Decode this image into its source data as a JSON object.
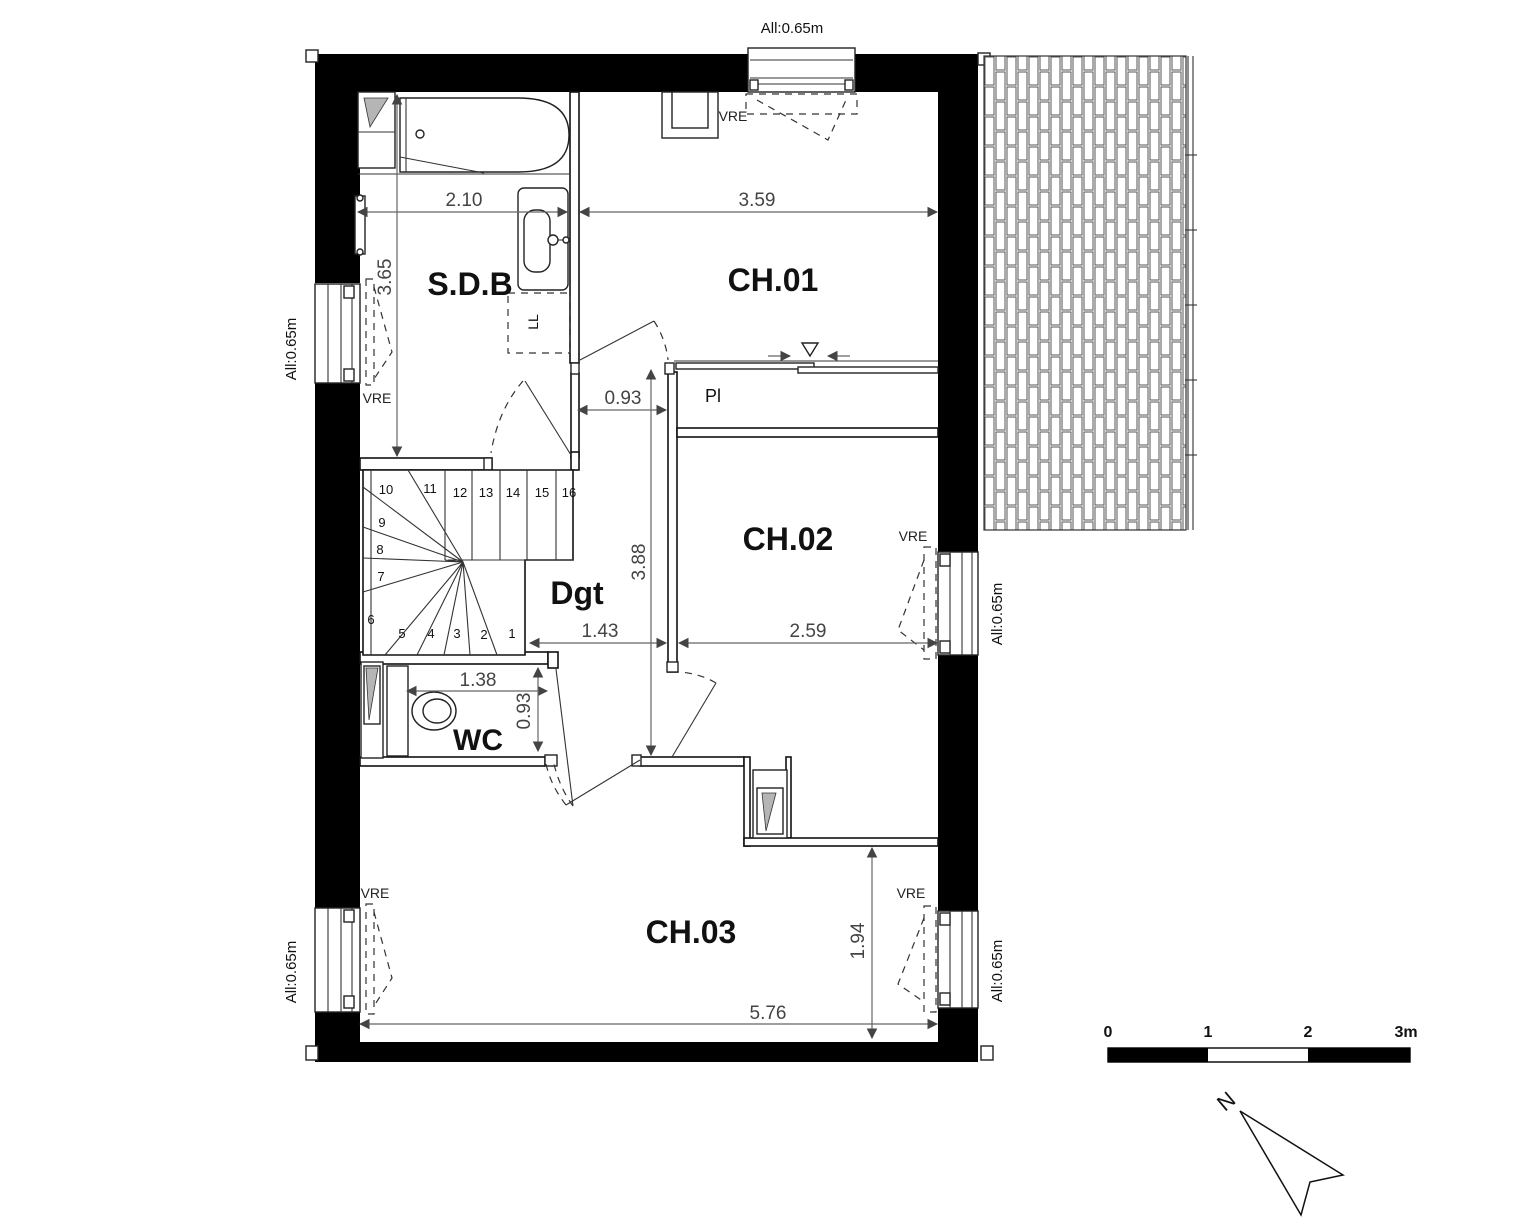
{
  "drawing": {
    "type": "architectural-floor-plan",
    "scale_bar": {
      "labels": [
        "0",
        "1",
        "2",
        "3m"
      ]
    },
    "north_label": "N",
    "rooms": [
      "S.D.B",
      "CH.01",
      "CH.02",
      "CH.03",
      "Dgt",
      "WC"
    ],
    "annotations": [
      "Pl",
      "LL",
      "VRE",
      "All:0.65m"
    ],
    "dimensions_m": [
      "2.10",
      "3.59",
      "3.65",
      "0.93",
      "3.88",
      "1.43",
      "2.59",
      "1.38",
      "0.93",
      "1.94",
      "5.76"
    ],
    "stair_steps": 16
  },
  "colors": {
    "wall": "#000000",
    "line": "#111111",
    "dimension": "#444444",
    "hatch_gray": "#b5b5b5",
    "background": "#ffffff"
  },
  "texts": [
    {
      "id": "room-label-sdb",
      "t": "S.D.B",
      "x": 470,
      "y": 295,
      "s": 32,
      "w": "bold"
    },
    {
      "id": "room-label-ch01",
      "t": "CH.01",
      "x": 773,
      "y": 291,
      "s": 32,
      "w": "bold"
    },
    {
      "id": "room-label-ch02",
      "t": "CH.02",
      "x": 788,
      "y": 550,
      "s": 32,
      "w": "bold"
    },
    {
      "id": "room-label-ch03",
      "t": "CH.03",
      "x": 691,
      "y": 943,
      "s": 32,
      "w": "bold"
    },
    {
      "id": "room-label-dgt",
      "t": "Dgt",
      "x": 577,
      "y": 604,
      "s": 32,
      "w": "bold"
    },
    {
      "id": "room-label-wc",
      "t": "WC",
      "x": 478,
      "y": 750,
      "s": 30,
      "w": "bold"
    },
    {
      "id": "closet-label-pl",
      "t": "Pl",
      "x": 713,
      "y": 402,
      "s": 18
    },
    {
      "id": "appliance-label-ll",
      "t": "LL",
      "x": 538,
      "y": 322,
      "s": 14,
      "r": -90
    },
    {
      "id": "dim-2-10",
      "t": "2.10",
      "x": 464,
      "y": 206,
      "s": 19,
      "c": "#444"
    },
    {
      "id": "dim-3-59",
      "t": "3.59",
      "x": 757,
      "y": 206,
      "s": 19,
      "c": "#444"
    },
    {
      "id": "dim-0-93-top",
      "t": "0.93",
      "x": 623,
      "y": 404,
      "s": 19,
      "c": "#444"
    },
    {
      "id": "dim-1-43",
      "t": "1.43",
      "x": 600,
      "y": 637,
      "s": 19,
      "c": "#444"
    },
    {
      "id": "dim-2-59",
      "t": "2.59",
      "x": 808,
      "y": 637,
      "s": 19,
      "c": "#444"
    },
    {
      "id": "dim-1-38",
      "t": "1.38",
      "x": 478,
      "y": 686,
      "s": 19,
      "c": "#444"
    },
    {
      "id": "dim-5-76",
      "t": "5.76",
      "x": 768,
      "y": 1019,
      "s": 19,
      "c": "#444"
    },
    {
      "id": "dim-3-65",
      "t": "3.65",
      "x": 391,
      "y": 277,
      "s": 19,
      "c": "#444",
      "r": -90
    },
    {
      "id": "dim-3-88",
      "t": "3.88",
      "x": 645,
      "y": 562,
      "s": 19,
      "c": "#444",
      "r": -90
    },
    {
      "id": "dim-0-93-wc",
      "t": "0.93",
      "x": 530,
      "y": 711,
      "s": 19,
      "c": "#444",
      "r": -90
    },
    {
      "id": "dim-1-94",
      "t": "1.94",
      "x": 864,
      "y": 941,
      "s": 19,
      "c": "#444",
      "r": -90
    },
    {
      "id": "sill-label-top",
      "t": "All:0.65m",
      "x": 792,
      "y": 33,
      "s": 15
    },
    {
      "id": "sill-label-left-upper",
      "t": "All:0.65m",
      "x": 296,
      "y": 349,
      "s": 15,
      "r": -90
    },
    {
      "id": "sill-label-left-lower",
      "t": "All:0.65m",
      "x": 296,
      "y": 972,
      "s": 15,
      "r": -90
    },
    {
      "id": "sill-label-right-ch02",
      "t": "All:0.65m",
      "x": 1002,
      "y": 614,
      "s": 15,
      "r": -90
    },
    {
      "id": "sill-label-right-ch03",
      "t": "All:0.65m",
      "x": 1002,
      "y": 971,
      "s": 15,
      "r": -90
    },
    {
      "id": "vre-ch01",
      "t": "VRE",
      "x": 733,
      "y": 121,
      "s": 14,
      "c": "#222"
    },
    {
      "id": "vre-sdb",
      "t": "VRE",
      "x": 377,
      "y": 403,
      "s": 14,
      "c": "#222"
    },
    {
      "id": "vre-ch02",
      "t": "VRE",
      "x": 913,
      "y": 541,
      "s": 14,
      "c": "#222"
    },
    {
      "id": "vre-ch03-left",
      "t": "VRE",
      "x": 375,
      "y": 898,
      "s": 14,
      "c": "#222"
    },
    {
      "id": "vre-ch03-right",
      "t": "VRE",
      "x": 911,
      "y": 898,
      "s": 14,
      "c": "#222"
    },
    {
      "id": "stair-step-1",
      "t": "1",
      "x": 512,
      "y": 638,
      "s": 13
    },
    {
      "id": "stair-step-2",
      "t": "2",
      "x": 484,
      "y": 639,
      "s": 13
    },
    {
      "id": "stair-step-3",
      "t": "3",
      "x": 457,
      "y": 638,
      "s": 13
    },
    {
      "id": "stair-step-4",
      "t": "4",
      "x": 431,
      "y": 638,
      "s": 13
    },
    {
      "id": "stair-step-5",
      "t": "5",
      "x": 402,
      "y": 638,
      "s": 13
    },
    {
      "id": "stair-step-6",
      "t": "6",
      "x": 371,
      "y": 624,
      "s": 13
    },
    {
      "id": "stair-step-7",
      "t": "7",
      "x": 381,
      "y": 581,
      "s": 13
    },
    {
      "id": "stair-step-8",
      "t": "8",
      "x": 380,
      "y": 554,
      "s": 13
    },
    {
      "id": "stair-step-9",
      "t": "9",
      "x": 382,
      "y": 527,
      "s": 13
    },
    {
      "id": "stair-step-10",
      "t": "10",
      "x": 386,
      "y": 494,
      "s": 13
    },
    {
      "id": "stair-step-11",
      "t": "11",
      "x": 430,
      "y": 493,
      "s": 13
    },
    {
      "id": "stair-step-12",
      "t": "12",
      "x": 460,
      "y": 497,
      "s": 13
    },
    {
      "id": "stair-step-13",
      "t": "13",
      "x": 486,
      "y": 497,
      "s": 13
    },
    {
      "id": "stair-step-14",
      "t": "14",
      "x": 513,
      "y": 497,
      "s": 13
    },
    {
      "id": "stair-step-15",
      "t": "15",
      "x": 542,
      "y": 497,
      "s": 13
    },
    {
      "id": "stair-step-16",
      "t": "16",
      "x": 569,
      "y": 497,
      "s": 13
    },
    {
      "id": "scale-0",
      "t": "0",
      "x": 1108,
      "y": 1037,
      "s": 16,
      "w": "bold"
    },
    {
      "id": "scale-1",
      "t": "1",
      "x": 1208,
      "y": 1037,
      "s": 16,
      "w": "bold"
    },
    {
      "id": "scale-2",
      "t": "2",
      "x": 1308,
      "y": 1037,
      "s": 16,
      "w": "bold"
    },
    {
      "id": "scale-3m",
      "t": "3m",
      "x": 1406,
      "y": 1037,
      "s": 16,
      "w": "bold"
    },
    {
      "id": "north-label",
      "t": "N",
      "x": 1231,
      "y": 1107,
      "s": 22,
      "r": -40
    }
  ]
}
